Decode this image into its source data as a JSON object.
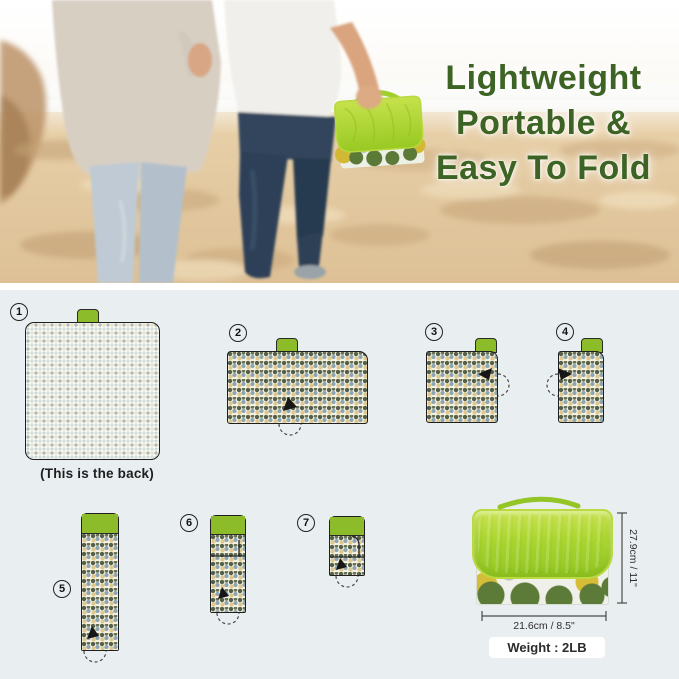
{
  "hero": {
    "title_lines": [
      "Lightweight",
      "Portable &",
      "Easy To Fold"
    ],
    "scene": "couple-walking-on-beach-carrying-folded-picnic-blanket"
  },
  "folding_steps": {
    "steps": [
      {
        "num": "1",
        "caption": "(This is the back)"
      },
      {
        "num": "2"
      },
      {
        "num": "3"
      },
      {
        "num": "4"
      },
      {
        "num": "5"
      },
      {
        "num": "6"
      },
      {
        "num": "7"
      }
    ]
  },
  "product_dimensions": {
    "height_label": "27.9cm / 11\"",
    "width_label": "21.6cm / 8.5\"",
    "weight_label": "Weight : 2LB"
  },
  "icons": {
    "step-badge": "numbered-circle",
    "fold-arrow-icon": "solid-triangle-with-dashed-arc"
  },
  "colors": {
    "accent_green": "#8dbc2b",
    "flap_green": "#a9d52f",
    "title_green": "#3d6424",
    "diagram_background": "#e9eef1",
    "pattern_olive": "#55604a",
    "pattern_blue": "#8da5b2",
    "pattern_tan": "#dfc88e"
  }
}
